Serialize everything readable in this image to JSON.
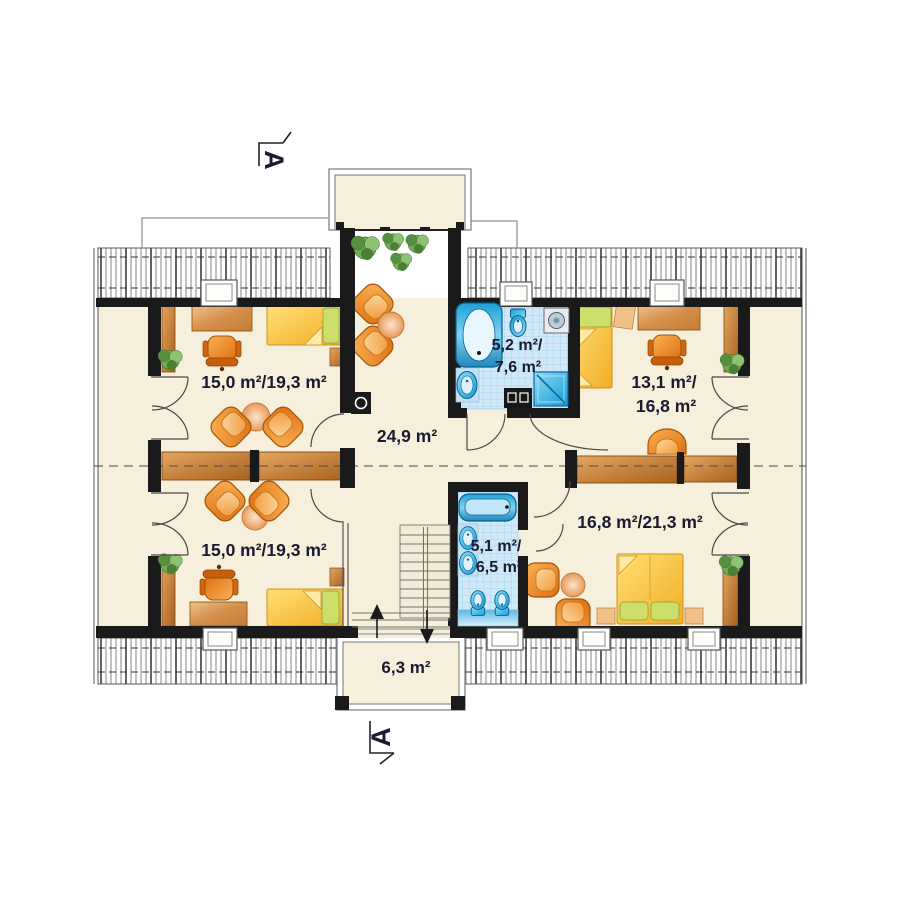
{
  "plan_type": "floor-plan",
  "section_markers": {
    "top": "A",
    "bottom": "A"
  },
  "rooms": {
    "bedroom_top_left": {
      "area": "15,0 m²/19,3 m²"
    },
    "hall": {
      "area": "24,9 m²"
    },
    "bathroom_top": {
      "line1": "5,2 m²/",
      "line2": "7,6 m²"
    },
    "bedroom_top_right": {
      "line1": "13,1 m²/",
      "line2": "16,8 m²"
    },
    "bedroom_bottom_left": {
      "area": "15,0 m²/19,3 m²"
    },
    "bathroom_bottom": {
      "line1": "5,1 m²/",
      "line2": "6,5 m²"
    },
    "bedroom_bottom_right": {
      "area": "16,8 m²/21,3 m²"
    },
    "balcony_bottom": {
      "area": "6,3 m²"
    }
  },
  "colors": {
    "floor_cream": "#f6efdb",
    "wall_black": "#1a1a1a",
    "furniture_orange": "#f08c2e",
    "wood_brown": "#c8823c",
    "bed_yellow": "#ffd24a",
    "pillow_green": "#cede6a",
    "bath_tile_blue": "#cfe9f8",
    "fixture_blue": "#129bd7",
    "label_text": "#1a1a30"
  }
}
